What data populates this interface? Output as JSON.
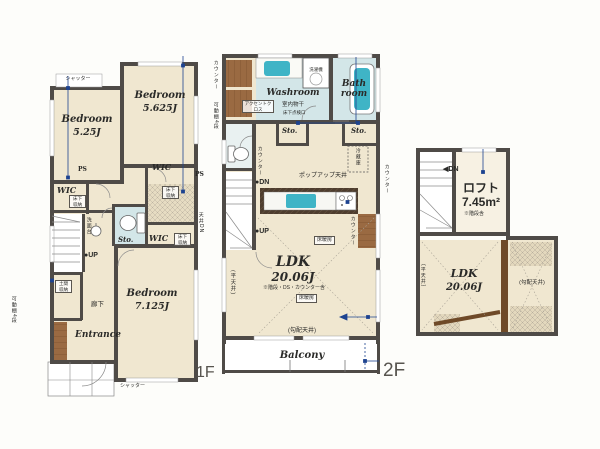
{
  "colors": {
    "wall": "#4f4b47",
    "floor": "#f0e7d0",
    "wet_room": "#d3e6e8",
    "tub": "#3fb4c6",
    "wood": "#9a6a42",
    "measure_line": "#1d4390"
  },
  "floor1": {
    "label": "1F",
    "shutter_top": "シャッター",
    "shutter_bottom": "シャッター",
    "bedroom1": {
      "name": "Bedroom",
      "size": "5.25J"
    },
    "bedroom2": {
      "name": "Bedroom",
      "size": "5.625J"
    },
    "bedroom3": {
      "name": "Bedroom",
      "size": "7.125J"
    },
    "wic_left": "WIC",
    "wic_right": "WIC",
    "wic_mid": "WIC",
    "ps_left": "PS",
    "ps_right": "PS",
    "sto": "Sto.",
    "underfloor_1": "床下収納",
    "underfloor_2": "床下収納",
    "underfloor_3": "床下収納",
    "washstand": "洗面台",
    "ceiling_note": "天井DN",
    "up": "●UP",
    "doma": "土間収納",
    "hallway": "廊下",
    "entrance": "Entrance",
    "shelf_note": "可動棚4段"
  },
  "floor2": {
    "label": "2F",
    "counter_left": "カウンター",
    "shelf_note": "可動棚4段",
    "washer": "洗濯機",
    "washroom": "Washroom",
    "accent_cloth": "アクセントクロス",
    "indoor_drying": "室内物干",
    "floor_hatch": "床下点検口",
    "bathroom": "Bath room",
    "sto_left": "Sto.",
    "sto_right": "Sto.",
    "fridge": "冷蔵庫",
    "counter_wc": "カウンター",
    "dn": "●DN",
    "up": "●UP",
    "popup_ceiling": "ポップアップ天井",
    "counter_kitchen": "カウンター",
    "counter_right": "カウンター",
    "floor_heating_1": "床暖房",
    "floor_heating_2": "床暖房",
    "ldk": {
      "name": "LDK",
      "size": "20.06J",
      "note": "※階段・DS・カウンター含"
    },
    "flat_ceiling": "(平天井)",
    "sloped_ceiling": "(勾配天井)",
    "balcony": "Balcony"
  },
  "loft": {
    "dn": "◀DN",
    "name": "ロフト",
    "size": "7.45m²",
    "note": "※階段含",
    "ldk": {
      "name": "LDK",
      "size": "20.06J"
    },
    "flat_ceiling": "(平天井)",
    "sloped_ceiling": "(勾配天井)"
  }
}
